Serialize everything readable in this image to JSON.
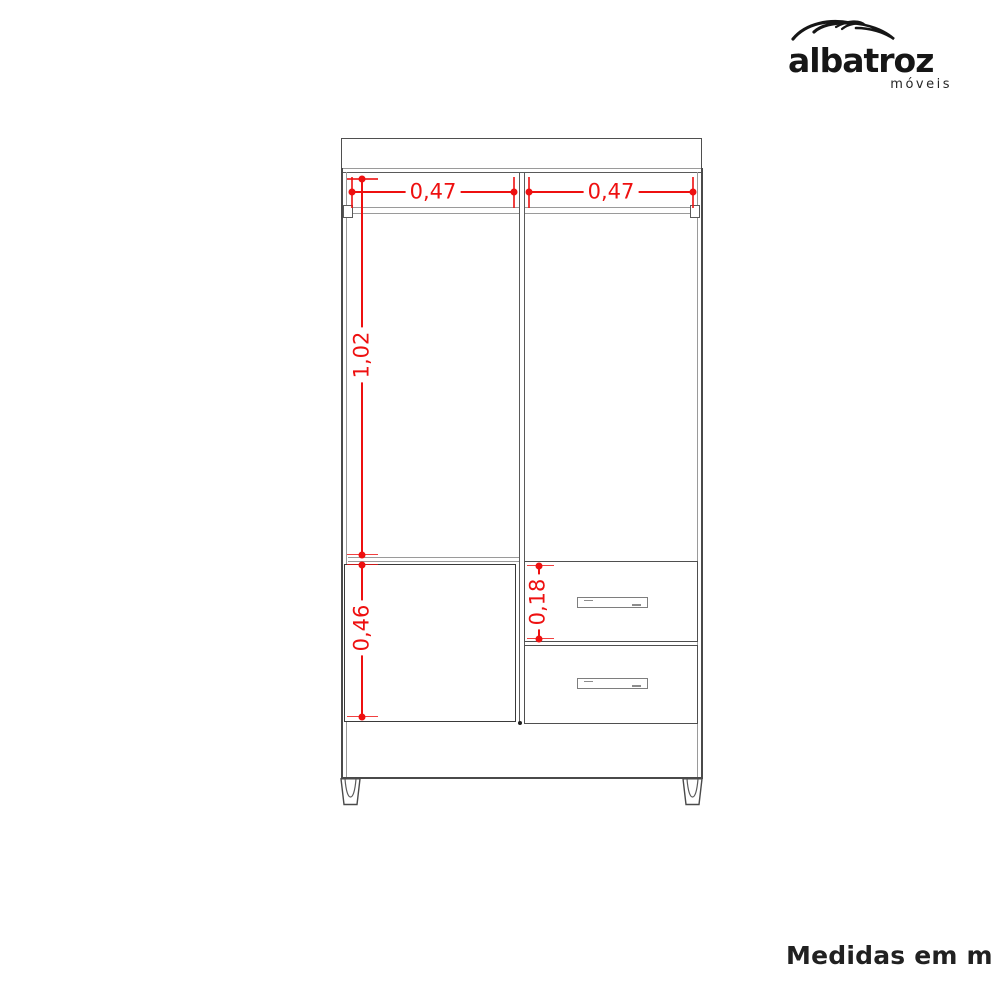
{
  "logo": {
    "name": "albatroz",
    "tagline": "móveis"
  },
  "caption": "Medidas em m",
  "dimensions": {
    "left_section_width": "0,47",
    "right_section_width": "0,47",
    "hanging_section_height": "1,02",
    "door_height": "0,46",
    "top_drawer_height": "0,18"
  },
  "colors": {
    "dimension_red": "#ee1010",
    "line_dark": "#4a4a4a",
    "line_light": "#9a9a9a",
    "logo_black": "#161616"
  }
}
